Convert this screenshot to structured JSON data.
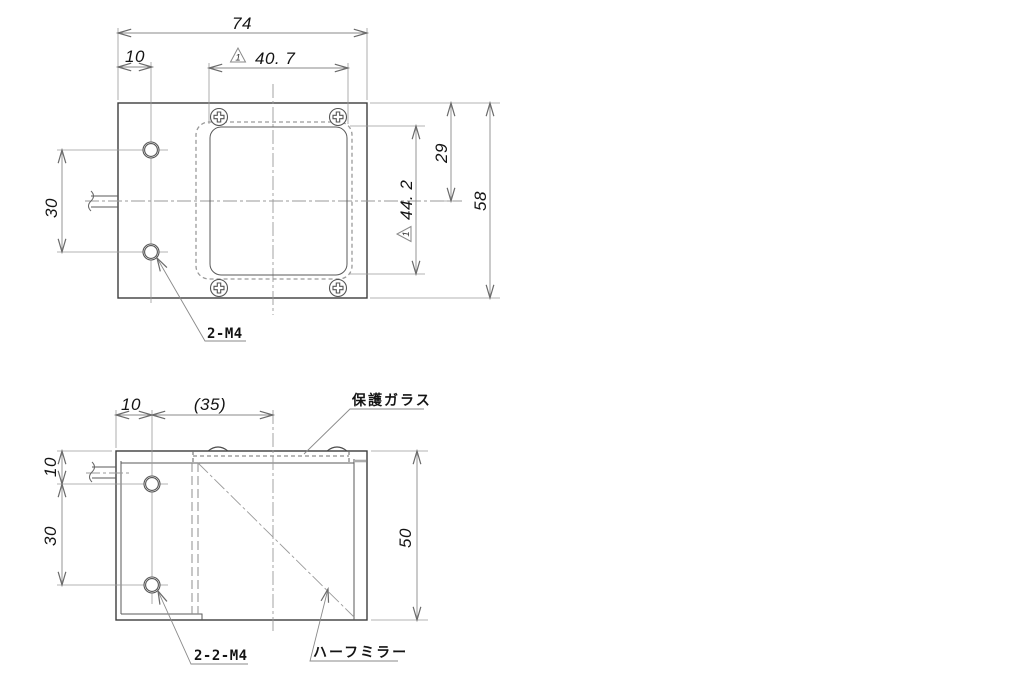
{
  "drawing": {
    "top_view": {
      "dim_total_width": "74",
      "dim_left_offset": "10",
      "dim_aperture_width": "40. 7",
      "dim_edge_to_center": "29",
      "dim_aperture_height": "44. 2",
      "dim_total_height": "58",
      "dim_hole_pitch": "30",
      "rev_mark": "1",
      "thread_label": "2-M4"
    },
    "side_view": {
      "dim_left_offset": "10",
      "dim_ref_width": "(35)",
      "dim_top_to_hole": "10",
      "dim_hole_pitch": "30",
      "dim_total_height": "50",
      "thread_label": "2-2-M4",
      "glass_label": "保護ガラス",
      "mirror_label": "ハーフミラー"
    }
  }
}
